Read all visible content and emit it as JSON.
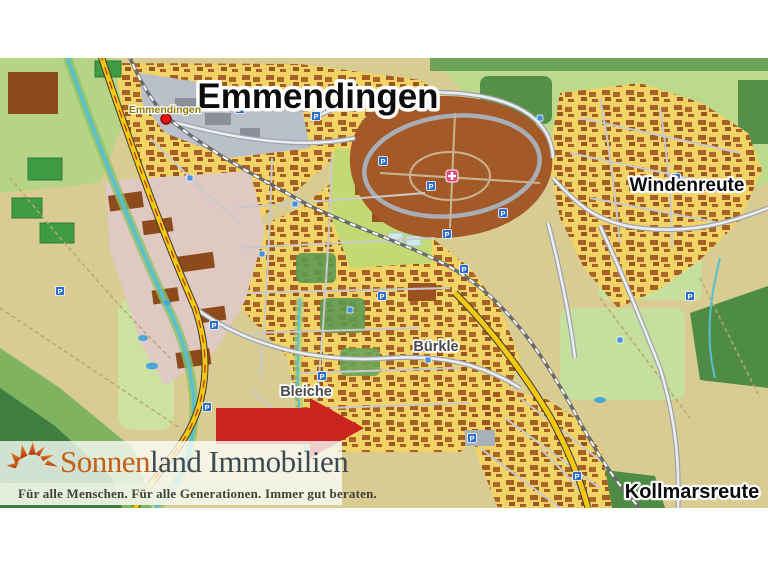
{
  "map": {
    "title": "Emmendingen",
    "station_label": "Emmendingen",
    "districts": {
      "windenreute": "Windenreute",
      "kollmarsreute": "Kollmarsreute",
      "buerkle": "Bürkle",
      "bleiche": "Bleiche"
    },
    "colors": {
      "fields": "#d9cc92",
      "meadow": "#bcd98c",
      "forest": "#4e8c46",
      "urban": "#f2d365",
      "buildings": "#9c5220",
      "industrial": "#dec9c3",
      "city_center": "#b9c0ca",
      "hospital_grounds": "#a35a28",
      "road_major": "#f6c80a",
      "river": "#57c0cf",
      "arrow": "#c9251c",
      "parking_icon": "#2a6fd0",
      "station_dot": "#e31212"
    },
    "icons": [
      {
        "type": "parking",
        "x": 60,
        "y": 233
      },
      {
        "type": "parking",
        "x": 207,
        "y": 349
      },
      {
        "type": "parking",
        "x": 235,
        "y": 358
      },
      {
        "type": "parking",
        "x": 383,
        "y": 103
      },
      {
        "type": "parking",
        "x": 431,
        "y": 128
      },
      {
        "type": "parking",
        "x": 503,
        "y": 155
      },
      {
        "type": "parking",
        "x": 214,
        "y": 267
      },
      {
        "type": "parking",
        "x": 447,
        "y": 176
      },
      {
        "type": "parking",
        "x": 464,
        "y": 211
      },
      {
        "type": "parking",
        "x": 382,
        "y": 238
      },
      {
        "type": "parking",
        "x": 322,
        "y": 318
      },
      {
        "type": "parking",
        "x": 472,
        "y": 380
      },
      {
        "type": "parking",
        "x": 676,
        "y": 120
      },
      {
        "type": "parking",
        "x": 690,
        "y": 238
      },
      {
        "type": "parking",
        "x": 577,
        "y": 418
      },
      {
        "type": "parking",
        "x": 240,
        "y": 51
      },
      {
        "type": "parking",
        "x": 316,
        "y": 58
      },
      {
        "type": "bus",
        "x": 295,
        "y": 146
      },
      {
        "type": "bus",
        "x": 262,
        "y": 196
      },
      {
        "type": "bus",
        "x": 350,
        "y": 252
      },
      {
        "type": "bus",
        "x": 302,
        "y": 382
      },
      {
        "type": "bus",
        "x": 428,
        "y": 302
      },
      {
        "type": "bus",
        "x": 620,
        "y": 282
      },
      {
        "type": "bus",
        "x": 540,
        "y": 60
      },
      {
        "type": "bus",
        "x": 190,
        "y": 120
      },
      {
        "type": "hospital",
        "x": 452,
        "y": 118
      },
      {
        "type": "station-dot",
        "x": 166,
        "y": 61
      }
    ]
  },
  "logo": {
    "brand_first": "Sonnen",
    "brand_rest": "land Immobilien",
    "tagline": "Für alle Menschen. Für alle Generationen. Immer gut beraten."
  }
}
